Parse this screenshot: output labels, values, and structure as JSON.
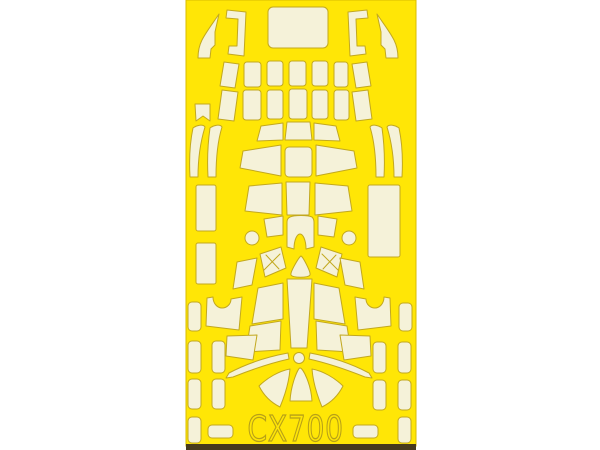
{
  "page": {
    "background_color": "#ffffff"
  },
  "sheet": {
    "product_code": "CX700",
    "description": "die-cut paint mask sheet",
    "colors": {
      "sheet_yellow": "#FFE606",
      "mask_cream": "#F5F2D9",
      "cut_line": "#C2A81F",
      "edge_line": "#D8BC00",
      "bottom_edge_dark": "#46391D",
      "text_outline": "#B7A018"
    },
    "frame": {
      "x": 186,
      "y": 0,
      "width": 230,
      "height": 446
    },
    "bottom_edge": {
      "x": 186,
      "y": 444,
      "width": 230,
      "height": 6
    },
    "label_position": {
      "x": 379,
      "y": 441,
      "scale_x": 0.78
    },
    "shapes": [
      {
        "name": "mask-windscreen-side-left",
        "kind": "path",
        "d": "M219,14 C213,23 206,32 202,40 C199,46 198,52 198,58 L210,58 L211,49 L215,45 L215,32 Z"
      },
      {
        "name": "mask-frame-bracket-left",
        "kind": "path",
        "d": "M227,10 L246,12 L244,56 L228,54 L229,46 L237,46 L238,19 L226,18 Z"
      },
      {
        "name": "mask-canopy-main",
        "kind": "rect",
        "x": 268,
        "y": 7,
        "w": 60,
        "h": 41,
        "rx": 5
      },
      {
        "name": "mask-frame-bracket-right",
        "kind": "path",
        "d": "M367,10 L348,12 L350,56 L366,54 L365,46 L357,46 L356,19 L368,18 Z"
      },
      {
        "name": "mask-windscreen-side-right",
        "kind": "path",
        "d": "M377,14 C383,23 390,32 394,40 C397,46 398,52 398,58 L386,58 L385,49 L381,45 L381,32 Z"
      },
      {
        "name": "mask-piece",
        "kind": "path",
        "d": "M224,62 L239,64 L235,88 L220,86 Z"
      },
      {
        "name": "mask-piece",
        "kind": "rect",
        "x": 244,
        "y": 62,
        "w": 17,
        "h": 25,
        "rx": 3
      },
      {
        "name": "mask-piece",
        "kind": "rect",
        "x": 267,
        "y": 61,
        "w": 16,
        "h": 25,
        "rx": 3
      },
      {
        "name": "mask-piece",
        "kind": "rect",
        "x": 289,
        "y": 61,
        "w": 17,
        "h": 25,
        "rx": 3
      },
      {
        "name": "mask-piece",
        "kind": "rect",
        "x": 312,
        "y": 61,
        "w": 16,
        "h": 25,
        "rx": 3
      },
      {
        "name": "mask-piece",
        "kind": "rect",
        "x": 334,
        "y": 62,
        "w": 14,
        "h": 25,
        "rx": 3
      },
      {
        "name": "mask-piece",
        "kind": "path",
        "d": "M352,64 L367,62 L371,86 L356,88 Z"
      },
      {
        "name": "mask-piece-notched",
        "kind": "path",
        "d": "M195,104 L210,104 L210,121 L203,116 L196,121 Z"
      },
      {
        "name": "mask-piece",
        "kind": "path",
        "d": "M222,90 L238,92 L234,121 L218,119 Z"
      },
      {
        "name": "mask-piece",
        "kind": "rect",
        "x": 243,
        "y": 90,
        "w": 18,
        "h": 30,
        "rx": 3
      },
      {
        "name": "mask-piece",
        "kind": "rect",
        "x": 267,
        "y": 90,
        "w": 16,
        "h": 29,
        "rx": 3
      },
      {
        "name": "mask-piece",
        "kind": "rect",
        "x": 289,
        "y": 89,
        "w": 18,
        "h": 30,
        "rx": 3
      },
      {
        "name": "mask-piece",
        "kind": "rect",
        "x": 312,
        "y": 90,
        "w": 16,
        "h": 29,
        "rx": 3
      },
      {
        "name": "mask-piece",
        "kind": "rect",
        "x": 334,
        "y": 90,
        "w": 15,
        "h": 30,
        "rx": 3
      },
      {
        "name": "mask-piece",
        "kind": "path",
        "d": "M352,92 L368,90 L372,119 L356,121 Z"
      },
      {
        "name": "mask-strip-curved",
        "kind": "path",
        "d": "M193,128 C197,125 203,124 205,127 C201,140 198,158 198,177 L190,177 C189,159 190,142 193,128 Z"
      },
      {
        "name": "mask-strip-curved",
        "kind": "path",
        "d": "M210,128 C214,125 220,124 222,127 C218,140 216,158 216,177 L208,177 C207,159 208,142 210,128 Z"
      },
      {
        "name": "mask-strip-curved",
        "kind": "path",
        "d": "M382,128 C378,125 372,124 370,127 C374,140 376,158 376,177 L384,177 C385,159 384,142 382,128 Z"
      },
      {
        "name": "mask-strip-curved",
        "kind": "path",
        "d": "M399,128 C395,125 389,124 387,127 C391,140 394,158 394,177 L402,177 C403,159 402,142 399,128 Z"
      },
      {
        "name": "mask-piece",
        "kind": "path",
        "d": "M261,126 L283,123 L283,140 L257,141 Z"
      },
      {
        "name": "mask-piece",
        "kind": "path",
        "d": "M287,122 L310,122 L312,140 L285,140 Z"
      },
      {
        "name": "mask-piece",
        "kind": "path",
        "d": "M314,123 L336,126 L340,141 L314,140 Z"
      },
      {
        "name": "mask-piece",
        "kind": "path",
        "d": "M243,151 L281,145 L281,176 L240,168 Z"
      },
      {
        "name": "mask-piece",
        "kind": "rect",
        "x": 285,
        "y": 147,
        "w": 27,
        "h": 30,
        "rx": 4
      },
      {
        "name": "mask-piece",
        "kind": "path",
        "d": "M316,145 L354,151 L357,168 L316,176 Z"
      },
      {
        "name": "mask-piece",
        "kind": "path",
        "d": "M249,186 L282,183 L282,215 L245,211 Z"
      },
      {
        "name": "mask-piece",
        "kind": "path",
        "d": "M286,182 L310,182 L309,215 L287,215 Z"
      },
      {
        "name": "mask-piece",
        "kind": "path",
        "d": "M315,183 L348,186 L352,211 L315,215 Z"
      },
      {
        "name": "mask-piece",
        "kind": "rect",
        "x": 196,
        "y": 185,
        "w": 20,
        "h": 46,
        "rx": 2
      },
      {
        "name": "mask-piece",
        "kind": "rect",
        "x": 196,
        "y": 243,
        "w": 20,
        "h": 41,
        "rx": 2
      },
      {
        "name": "mask-piece",
        "kind": "rect",
        "x": 368,
        "y": 185,
        "w": 32,
        "h": 72,
        "rx": 2
      },
      {
        "name": "mask-piece",
        "kind": "path",
        "d": "M264,219 L283,216 L283,235 L267,237 Z"
      },
      {
        "name": "mask-arch",
        "kind": "path",
        "d": "M290,217 C294,215 308,215 312,217 C313,218 314,220 314,222 L314,247 L306,249 C306,240 303,234 300,234 C297,234 294,240 294,249 L287,247 L287,222 C287,220 288,218 290,217 Z"
      },
      {
        "name": "mask-piece",
        "kind": "path",
        "d": "M318,216 L337,219 L334,237 L318,235 Z"
      },
      {
        "name": "mask-dot",
        "kind": "circle",
        "cx": 252,
        "cy": 238,
        "r": 7
      },
      {
        "name": "mask-dot",
        "kind": "circle",
        "cx": 349,
        "cy": 238,
        "r": 7
      },
      {
        "name": "mask-piece-crossed",
        "kind": "path",
        "d": "M260,254 L281,247 L286,268 L265,277 Z"
      },
      {
        "name": "cut-cross-mark",
        "kind": "line",
        "x1": 266,
        "y1": 255,
        "x2": 279,
        "y2": 269
      },
      {
        "name": "cut-cross-mark",
        "kind": "line",
        "x1": 280,
        "y1": 254,
        "x2": 264,
        "y2": 270
      },
      {
        "name": "mask-piece-crossed",
        "kind": "path",
        "d": "M321,247 L342,254 L337,277 L316,268 Z"
      },
      {
        "name": "cut-cross-mark",
        "kind": "line",
        "x1": 336,
        "y1": 255,
        "x2": 323,
        "y2": 269
      },
      {
        "name": "cut-cross-mark",
        "kind": "line",
        "x1": 322,
        "y1": 254,
        "x2": 338,
        "y2": 270
      },
      {
        "name": "mask-triangle",
        "kind": "path",
        "d": "M301,256 C303,257 311,272 310,275 C308,278 293,278 291,275 C290,272 299,257 301,256 Z"
      },
      {
        "name": "mask-fan-center",
        "kind": "path",
        "d": "M287,279 L312,279 L307,348 L291,348 Z"
      },
      {
        "name": "mask-piece",
        "kind": "path",
        "d": "M258,288 L283,283 L283,319 L252,324 Z"
      },
      {
        "name": "mask-piece",
        "kind": "path",
        "d": "M250,326 L281,321 L280,350 L246,352 Z"
      },
      {
        "name": "mask-piece",
        "kind": "path",
        "d": "M339,288 L314,283 L314,319 L345,324 Z"
      },
      {
        "name": "mask-piece",
        "kind": "path",
        "d": "M347,326 L316,321 L317,350 L351,352 Z"
      },
      {
        "name": "mask-piece",
        "kind": "path",
        "d": "M237,262 L257,258 L252,285 L233,289 Z"
      },
      {
        "name": "mask-piece-notched",
        "kind": "path",
        "d": "M207,298 L213,297 C213,303 217,308 222,308 C227,308 231,304 231,299 L242,297 L239,330 L206,326 Z"
      },
      {
        "name": "mask-piece",
        "kind": "path",
        "d": "M227,336 L257,335 L253,360 L226,356 Z"
      },
      {
        "name": "mask-piece",
        "kind": "path",
        "d": "M360,262 L340,258 L345,285 L364,289 Z"
      },
      {
        "name": "mask-piece-notched",
        "kind": "path",
        "d": "M390,298 L384,297 C384,303 380,308 375,308 C370,308 366,304 366,299 L355,297 L358,330 L391,326 Z"
      },
      {
        "name": "mask-piece",
        "kind": "path",
        "d": "M370,336 L340,335 L344,360 L371,356 Z"
      },
      {
        "name": "mask-hub-dot",
        "kind": "circle",
        "cx": 299,
        "cy": 358,
        "r": 5.5
      },
      {
        "name": "mask-blade",
        "kind": "path",
        "d": "M288,353 C266,357 246,364 229,373 L226,378 L233,377 C253,369 271,363 289,359 Z"
      },
      {
        "name": "mask-blade",
        "kind": "path",
        "d": "M310,353 C332,357 352,364 369,373 L372,378 L365,377 C345,369 327,363 309,359 Z"
      },
      {
        "name": "mask-skirt-wedge",
        "kind": "path",
        "d": "M290,369 C279,371 267,378 259,386 C264,396 272,403 280,407 C285,395 289,382 290,369 Z"
      },
      {
        "name": "mask-skirt-wedge",
        "kind": "path",
        "d": "M300,368 C303,368 311,384 312,401 L290,401 C291,384 298,368 300,368 Z"
      },
      {
        "name": "mask-skirt-wedge",
        "kind": "path",
        "d": "M312,369 C323,371 335,378 343,386 C338,396 330,403 322,407 C317,395 313,382 312,369 Z"
      },
      {
        "name": "mask-piece",
        "kind": "rect",
        "x": 188,
        "y": 302,
        "w": 13,
        "h": 29,
        "rx": 4
      },
      {
        "name": "mask-piece",
        "kind": "rect",
        "x": 188,
        "y": 341,
        "w": 13,
        "h": 32,
        "rx": 4
      },
      {
        "name": "mask-piece",
        "kind": "rect",
        "x": 212,
        "y": 341,
        "w": 13,
        "h": 32,
        "rx": 4
      },
      {
        "name": "mask-piece",
        "kind": "rect",
        "x": 188,
        "y": 379,
        "w": 13,
        "h": 30,
        "rx": 4
      },
      {
        "name": "mask-piece",
        "kind": "rect",
        "x": 212,
        "y": 379,
        "w": 13,
        "h": 30,
        "rx": 4
      },
      {
        "name": "mask-piece",
        "kind": "rect",
        "x": 188,
        "y": 417,
        "w": 13,
        "h": 26,
        "rx": 4
      },
      {
        "name": "mask-piece",
        "kind": "rect",
        "x": 208,
        "y": 425,
        "w": 25,
        "h": 13,
        "rx": 4
      },
      {
        "name": "mask-piece",
        "kind": "rect",
        "x": 399,
        "y": 303,
        "w": 13,
        "h": 28,
        "rx": 4
      },
      {
        "name": "mask-piece",
        "kind": "rect",
        "x": 373,
        "y": 342,
        "w": 13,
        "h": 31,
        "rx": 4
      },
      {
        "name": "mask-piece",
        "kind": "rect",
        "x": 398,
        "y": 342,
        "w": 13,
        "h": 31,
        "rx": 4
      },
      {
        "name": "mask-piece",
        "kind": "rect",
        "x": 373,
        "y": 380,
        "w": 13,
        "h": 30,
        "rx": 4
      },
      {
        "name": "mask-piece",
        "kind": "rect",
        "x": 398,
        "y": 380,
        "w": 13,
        "h": 30,
        "rx": 4
      },
      {
        "name": "mask-piece",
        "kind": "rect",
        "x": 398,
        "y": 417,
        "w": 13,
        "h": 26,
        "rx": 4
      },
      {
        "name": "mask-piece",
        "kind": "rect",
        "x": 353,
        "y": 425,
        "w": 25,
        "h": 13,
        "rx": 4
      }
    ]
  }
}
